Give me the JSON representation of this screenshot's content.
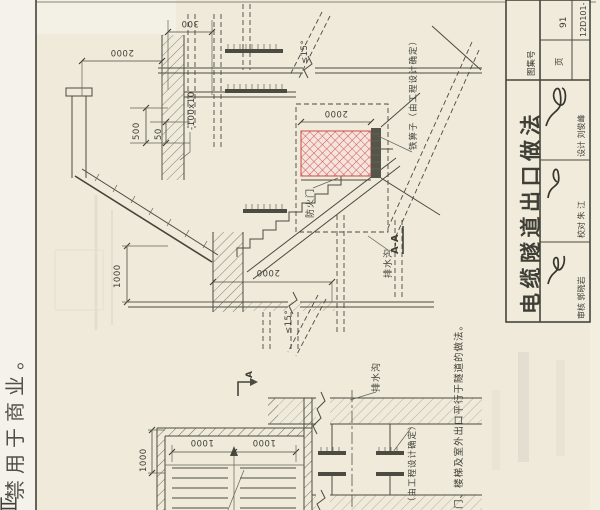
{
  "colors": {
    "paper": "#efead9",
    "line": "#4b4b42",
    "title_red": "#b03a30",
    "red_hatch": "#cb4f47",
    "watermark_gray": "#c1beb8",
    "watermark_teal": "#9bbcb4"
  },
  "title_block": {
    "atlas_label": "图集号",
    "atlas_value": "12D101-",
    "page_label": "页",
    "page_value": "91",
    "drawing_title": "电缆隧道出口做法",
    "staff": [
      {
        "role_name": "审核 郭晓岩"
      },
      {
        "role_name": "校对 朱 江"
      },
      {
        "role_name": "设计 刘俊峰"
      }
    ]
  },
  "section": {
    "name": "A-A",
    "dims": {
      "d300": "300",
      "d2000_canopy": "2000",
      "d500": "500",
      "d50": "50",
      "plate": "-100x10",
      "slope_top": "≤15°",
      "d2000_grate": "2000",
      "d1000_wall": "1000",
      "d2000_floor": "2000",
      "slope_bottom": "≤15°"
    },
    "labels": {
      "grate": "铁箅子（由工程设计确定）",
      "fire_door": "防火门",
      "drain": "排水沟"
    }
  },
  "plan": {
    "cut_mark": "A",
    "dims": {
      "d1000_left": "1000",
      "d1000_a": "1000",
      "d1000_b": "1000"
    },
    "labels": {
      "drain": "排水沟",
      "bracket": "（由工程设计确定）"
    },
    "note": "门、楼梯及室外出口平行于隧道的做法。"
  },
  "watermark": {
    "text": "禁用于商业。",
    "partial": "亚"
  }
}
